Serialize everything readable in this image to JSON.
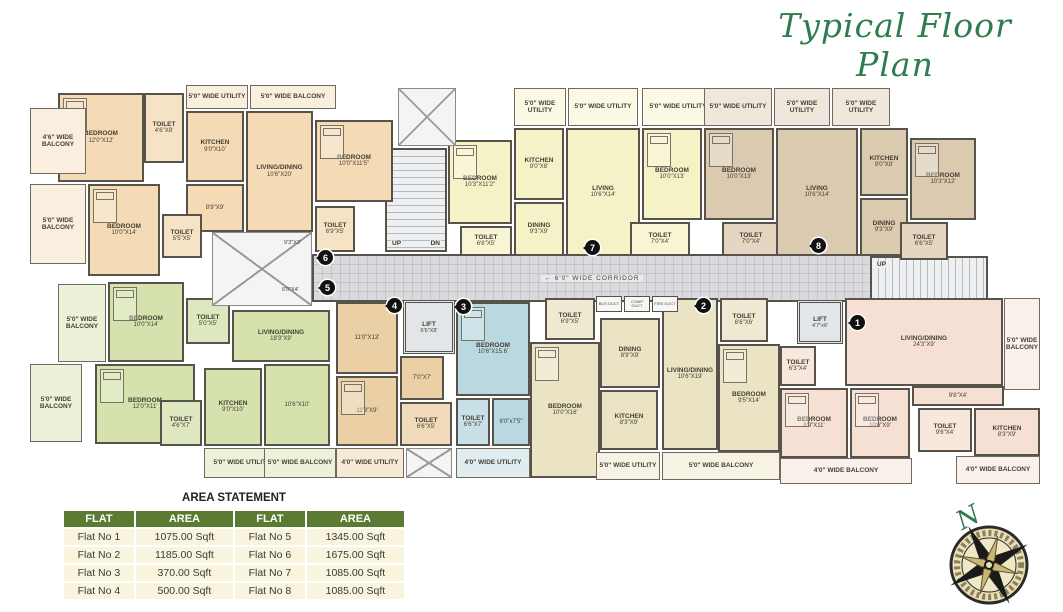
{
  "title": "Typical Floor Plan",
  "compass": {
    "north_label": "N"
  },
  "area_statement": {
    "title": "AREA STATEMENT",
    "columns": [
      "FLAT",
      "AREA",
      "FLAT",
      "AREA"
    ],
    "rows": [
      [
        "Flat No 1",
        "1075.00 Sqft",
        "Flat No 5",
        "1345.00 Sqft"
      ],
      [
        "Flat No 2",
        "1185.00 Sqft",
        "Flat No 6",
        "1675.00 Sqft"
      ],
      [
        "Flat No 3",
        "370.00 Sqft",
        "Flat No 7",
        "1085.00 Sqft"
      ],
      [
        "Flat No 4",
        "500.00 Sqft",
        "Flat No 8",
        "1085.00 Sqft"
      ]
    ]
  },
  "colors": {
    "wall": "#57524a",
    "flat1_pink": "#f5e0d3",
    "flat2_khaki": "#eae4c4",
    "flat3_blue": "#b9d8e0",
    "flat4_tan": "#ebd0a6",
    "flat5_green": "#d5e2ae",
    "flat6_peach": "#f4dbb6",
    "flat7_yellow": "#f6f2c8",
    "flat8_brown": "#dccab0",
    "table_header_green": "#5b7b33",
    "title_green": "#2e7d4f"
  },
  "common": {
    "corridor": {
      "label": "6'0\" WIDE CORRIDOR",
      "arrow": "←",
      "x": 312,
      "y": 254,
      "w": 560,
      "h": 48
    },
    "stairs": [
      {
        "dir": "h",
        "x": 385,
        "y": 148,
        "w": 62,
        "h": 104,
        "up": "UP",
        "dn": "DN"
      },
      {
        "dir": "v",
        "x": 870,
        "y": 256,
        "w": 118,
        "h": 62,
        "up": "UP",
        "dn": "DN"
      }
    ],
    "lifts": [
      {
        "label": "LIFT",
        "dims": "6'6\"X8'",
        "x": 403,
        "y": 300,
        "w": 52,
        "h": 54
      },
      {
        "label": "LIFT",
        "dims": "4'7\"x6'",
        "x": 797,
        "y": 300,
        "w": 46,
        "h": 44
      }
    ],
    "voids": [
      {
        "x": 212,
        "y": 232,
        "w": 100,
        "h": 74
      },
      {
        "x": 398,
        "y": 88,
        "w": 58,
        "h": 58
      },
      {
        "x": 406,
        "y": 448,
        "w": 46,
        "h": 30
      }
    ],
    "ducts": [
      {
        "label": "BUS DUCT",
        "x": 596,
        "y": 296,
        "w": 26,
        "h": 16
      },
      {
        "label": "COMP DUCT",
        "x": 624,
        "y": 296,
        "w": 26,
        "h": 16
      },
      {
        "label": "FIRE DUCT",
        "x": 652,
        "y": 296,
        "w": 26,
        "h": 16
      }
    ],
    "annotations": [
      {
        "text": "9'3\"X3'",
        "x": 284,
        "y": 240
      },
      {
        "text": "6'0\"X4'",
        "x": 282,
        "y": 287
      }
    ]
  },
  "flats": [
    {
      "no": "6",
      "color": "#f4dbb6",
      "marker": {
        "x": 325,
        "y": 257
      },
      "rooms": [
        {
          "label": "BEDROOM",
          "dims": "12'0\"X12'",
          "x": 58,
          "y": 93,
          "w": 86,
          "h": 89,
          "type": "room",
          "bed": true
        },
        {
          "label": "TOILET",
          "dims": "4'6\"X8'",
          "x": 144,
          "y": 93,
          "w": 40,
          "h": 70,
          "type": "toilet"
        },
        {
          "label": "5'0\" WIDE UTILITY",
          "dims": "",
          "x": 186,
          "y": 85,
          "w": 62,
          "h": 24,
          "type": "balcony"
        },
        {
          "label": "5'0\" WIDE BALCONY",
          "dims": "",
          "x": 250,
          "y": 85,
          "w": 86,
          "h": 24,
          "type": "balcony"
        },
        {
          "label": "4'6\" WIDE BALCONY",
          "dims": "",
          "x": 30,
          "y": 108,
          "w": 56,
          "h": 66,
          "type": "balcony"
        },
        {
          "label": "KITCHEN",
          "dims": "9'0\"X10'",
          "x": 186,
          "y": 111,
          "w": 58,
          "h": 71,
          "type": "room"
        },
        {
          "label": "LIVING/DINING",
          "dims": "10'6\"X20'",
          "x": 246,
          "y": 111,
          "w": 67,
          "h": 121,
          "type": "room"
        },
        {
          "label": "",
          "dims": "8'9\"X9'",
          "x": 186,
          "y": 184,
          "w": 58,
          "h": 48,
          "type": "room"
        },
        {
          "label": "BEDROOM",
          "dims": "10'0\"X14'",
          "x": 88,
          "y": 184,
          "w": 72,
          "h": 92,
          "type": "room",
          "bed": true
        },
        {
          "label": "5'0\" WIDE BALCONY",
          "dims": "",
          "x": 30,
          "y": 184,
          "w": 56,
          "h": 80,
          "type": "balcony"
        },
        {
          "label": "TOILET",
          "dims": "5'5\"X5'",
          "x": 162,
          "y": 214,
          "w": 40,
          "h": 44,
          "type": "toilet"
        },
        {
          "label": "BEDROOM",
          "dims": "10'0\"X11'5\"",
          "x": 315,
          "y": 120,
          "w": 78,
          "h": 82,
          "type": "room",
          "bed": true
        },
        {
          "label": "TOILET",
          "dims": "6'9\"X5'",
          "x": 315,
          "y": 206,
          "w": 40,
          "h": 46,
          "type": "toilet"
        }
      ]
    },
    {
      "no": "7",
      "color": "#f6f2c8",
      "marker": {
        "x": 592,
        "y": 247
      },
      "rooms": [
        {
          "label": "BEDROOM",
          "dims": "10'3\"X11'2\"",
          "x": 448,
          "y": 140,
          "w": 64,
          "h": 84,
          "type": "room",
          "bed": true
        },
        {
          "label": "TOILET",
          "dims": "6'6\"X5'",
          "x": 460,
          "y": 226,
          "w": 52,
          "h": 30,
          "type": "toilet"
        },
        {
          "label": "5'0\" WIDE UTILITY",
          "dims": "",
          "x": 514,
          "y": 88,
          "w": 52,
          "h": 38,
          "type": "balcony"
        },
        {
          "label": "5'0\" WIDE UTILITY",
          "dims": "",
          "x": 568,
          "y": 88,
          "w": 70,
          "h": 38,
          "type": "balcony"
        },
        {
          "label": "KITCHEN",
          "dims": "9'0\"X8'",
          "x": 514,
          "y": 128,
          "w": 50,
          "h": 72,
          "type": "room"
        },
        {
          "label": "DINING",
          "dims": "9'3\"X9'",
          "x": 514,
          "y": 202,
          "w": 50,
          "h": 54,
          "type": "room"
        },
        {
          "label": "LIVING",
          "dims": "10'6\"X14'",
          "x": 566,
          "y": 128,
          "w": 74,
          "h": 128,
          "type": "room"
        },
        {
          "label": "5'0\" WIDE UTILITY",
          "dims": "",
          "x": 642,
          "y": 88,
          "w": 72,
          "h": 38,
          "type": "balcony"
        },
        {
          "label": "BEDROOM",
          "dims": "10'0\"X13'",
          "x": 642,
          "y": 128,
          "w": 60,
          "h": 92,
          "type": "room",
          "bed": true
        },
        {
          "label": "TOILET",
          "dims": "7'0\"X4'",
          "x": 630,
          "y": 222,
          "w": 60,
          "h": 34,
          "type": "toilet"
        }
      ]
    },
    {
      "no": "8",
      "color": "#dccab0",
      "marker": {
        "x": 818,
        "y": 245
      },
      "rooms": [
        {
          "label": "5'0\" WIDE UTILITY",
          "dims": "",
          "x": 704,
          "y": 88,
          "w": 68,
          "h": 38,
          "type": "balcony"
        },
        {
          "label": "5'0\" WIDE UTILITY",
          "dims": "",
          "x": 774,
          "y": 88,
          "w": 56,
          "h": 38,
          "type": "balcony"
        },
        {
          "label": "5'0\" WIDE UTILITY",
          "dims": "",
          "x": 832,
          "y": 88,
          "w": 58,
          "h": 38,
          "type": "balcony"
        },
        {
          "label": "BEDROOM",
          "dims": "10'0\"X13'",
          "x": 704,
          "y": 128,
          "w": 70,
          "h": 92,
          "type": "room",
          "bed": true
        },
        {
          "label": "TOILET",
          "dims": "7'0\"X4'",
          "x": 722,
          "y": 222,
          "w": 58,
          "h": 34,
          "type": "toilet"
        },
        {
          "label": "LIVING",
          "dims": "10'6\"X14'",
          "x": 776,
          "y": 128,
          "w": 82,
          "h": 128,
          "type": "room"
        },
        {
          "label": "KITCHEN",
          "dims": "9'0\"X8'",
          "x": 860,
          "y": 128,
          "w": 48,
          "h": 68,
          "type": "room"
        },
        {
          "label": "DINING",
          "dims": "9'3\"X9'",
          "x": 860,
          "y": 198,
          "w": 48,
          "h": 58,
          "type": "room"
        },
        {
          "label": "BEDROOM",
          "dims": "10'3\"X12'",
          "x": 910,
          "y": 138,
          "w": 66,
          "h": 82,
          "type": "room",
          "bed": true
        },
        {
          "label": "TOILET",
          "dims": "6'6\"X5'",
          "x": 900,
          "y": 222,
          "w": 48,
          "h": 38,
          "type": "toilet"
        }
      ]
    },
    {
      "no": "5",
      "color": "#d5e2ae",
      "marker": {
        "x": 327,
        "y": 287
      },
      "rooms": [
        {
          "label": "5'0\" WIDE BALCONY",
          "dims": "",
          "x": 58,
          "y": 284,
          "w": 48,
          "h": 78,
          "type": "balcony"
        },
        {
          "label": "BEDROOM",
          "dims": "10'0\"X14'",
          "x": 108,
          "y": 282,
          "w": 76,
          "h": 80,
          "type": "room",
          "bed": true
        },
        {
          "label": "TOILET",
          "dims": "5'0\"X5'",
          "x": 186,
          "y": 298,
          "w": 44,
          "h": 46,
          "type": "toilet"
        },
        {
          "label": "BEDROOM",
          "dims": "12'0\"X11'",
          "x": 95,
          "y": 364,
          "w": 100,
          "h": 80,
          "type": "room",
          "bed": true
        },
        {
          "label": "5'0\" WIDE BALCONY",
          "dims": "",
          "x": 30,
          "y": 364,
          "w": 52,
          "h": 78,
          "type": "balcony"
        },
        {
          "label": "TOILET",
          "dims": "4'6\"X7'",
          "x": 160,
          "y": 400,
          "w": 42,
          "h": 46,
          "type": "toilet"
        },
        {
          "label": "KITCHEN",
          "dims": "9'0\"X10'",
          "x": 204,
          "y": 368,
          "w": 58,
          "h": 78,
          "type": "room"
        },
        {
          "label": "5'0\" WIDE UTILITY",
          "dims": "",
          "x": 204,
          "y": 448,
          "w": 76,
          "h": 30,
          "type": "balcony"
        },
        {
          "label": "LIVING/DINING",
          "dims": "18'3\"X9'",
          "x": 232,
          "y": 310,
          "w": 98,
          "h": 52,
          "type": "room"
        },
        {
          "label": "",
          "dims": "10'6\"X10'",
          "x": 264,
          "y": 364,
          "w": 66,
          "h": 82,
          "type": "room"
        },
        {
          "label": "5'0\" WIDE BALCONY",
          "dims": "",
          "x": 264,
          "y": 448,
          "w": 72,
          "h": 30,
          "type": "balcony"
        }
      ]
    },
    {
      "no": "4",
      "color": "#ebd0a6",
      "marker": {
        "x": 394,
        "y": 305
      },
      "rooms": [
        {
          "label": "",
          "dims": "11'0\"X13'",
          "x": 336,
          "y": 302,
          "w": 62,
          "h": 72,
          "type": "room"
        },
        {
          "label": "",
          "dims": "11'3\"X9'",
          "x": 336,
          "y": 376,
          "w": 62,
          "h": 70,
          "type": "room",
          "bed": true
        },
        {
          "label": "",
          "dims": "7'0\"X7'",
          "x": 400,
          "y": 356,
          "w": 44,
          "h": 44,
          "type": "room"
        },
        {
          "label": "TOILET",
          "dims": "6'6\"X5'",
          "x": 400,
          "y": 402,
          "w": 52,
          "h": 44,
          "type": "toilet"
        },
        {
          "label": "4'0\" WIDE UTILITY",
          "dims": "",
          "x": 336,
          "y": 448,
          "w": 68,
          "h": 30,
          "type": "balcony"
        }
      ]
    },
    {
      "no": "3",
      "color": "#b9d8e0",
      "marker": {
        "x": 463,
        "y": 306
      },
      "rooms": [
        {
          "label": "BEDROOM",
          "dims": "10'6\"X15.6'",
          "x": 456,
          "y": 302,
          "w": 74,
          "h": 94,
          "type": "room",
          "bed": true
        },
        {
          "label": "TOILET",
          "dims": "6'6\"X7'",
          "x": 456,
          "y": 398,
          "w": 34,
          "h": 48,
          "type": "toilet"
        },
        {
          "label": "",
          "dims": "6'0\"x7'5\"",
          "x": 492,
          "y": 398,
          "w": 38,
          "h": 48,
          "type": "room"
        },
        {
          "label": "4'0\" WIDE UTILITY",
          "dims": "",
          "x": 456,
          "y": 448,
          "w": 74,
          "h": 30,
          "type": "balcony"
        }
      ]
    },
    {
      "no": "2",
      "color": "#eae4c4",
      "marker": {
        "x": 703,
        "y": 305
      },
      "rooms": [
        {
          "label": "TOILET",
          "dims": "6'9\"X5'",
          "x": 545,
          "y": 298,
          "w": 50,
          "h": 42,
          "type": "toilet"
        },
        {
          "label": "BEDROOM",
          "dims": "10'0\"X16'",
          "x": 530,
          "y": 342,
          "w": 70,
          "h": 136,
          "type": "room",
          "bed": true
        },
        {
          "label": "DINING",
          "dims": "8'9\"X9'",
          "x": 600,
          "y": 318,
          "w": 60,
          "h": 70,
          "type": "room"
        },
        {
          "label": "KITCHEN",
          "dims": "8'3\"X9'",
          "x": 600,
          "y": 390,
          "w": 58,
          "h": 60,
          "type": "room"
        },
        {
          "label": "LIVING/DINING",
          "dims": "10'6\"X19'",
          "x": 662,
          "y": 298,
          "w": 56,
          "h": 152,
          "type": "room"
        },
        {
          "label": "TOILET",
          "dims": "6'6\"X6'",
          "x": 720,
          "y": 298,
          "w": 48,
          "h": 44,
          "type": "toilet"
        },
        {
          "label": "BEDROOM",
          "dims": "9'5\"X14'",
          "x": 718,
          "y": 344,
          "w": 62,
          "h": 108,
          "type": "room",
          "bed": true
        },
        {
          "label": "5'0\" WIDE UTILITY",
          "dims": "",
          "x": 596,
          "y": 452,
          "w": 64,
          "h": 28,
          "type": "balcony"
        },
        {
          "label": "5'0\" WIDE BALCONY",
          "dims": "",
          "x": 662,
          "y": 452,
          "w": 118,
          "h": 28,
          "type": "balcony"
        }
      ]
    },
    {
      "no": "1",
      "color": "#f5e0d3",
      "marker": {
        "x": 857,
        "y": 322
      },
      "rooms": [
        {
          "label": "LIVING/DINING",
          "dims": "24'3\"X9'",
          "x": 845,
          "y": 298,
          "w": 158,
          "h": 88,
          "type": "room"
        },
        {
          "label": "5'0\" WIDE BALCONY",
          "dims": "",
          "x": 1004,
          "y": 298,
          "w": 36,
          "h": 92,
          "type": "balcony"
        },
        {
          "label": "TOILET",
          "dims": "6'3\"X4'",
          "x": 780,
          "y": 346,
          "w": 36,
          "h": 40,
          "type": "toilet"
        },
        {
          "label": "BEDROOM",
          "dims": "9'9\"X11'",
          "x": 780,
          "y": 388,
          "w": 68,
          "h": 70,
          "type": "room",
          "bed": true
        },
        {
          "label": "BEDROOM",
          "dims": "10'6\"X9'",
          "x": 850,
          "y": 388,
          "w": 60,
          "h": 70,
          "type": "room",
          "bed": true
        },
        {
          "label": "",
          "dims": "9'6\"X4'",
          "x": 912,
          "y": 386,
          "w": 92,
          "h": 20,
          "type": "room"
        },
        {
          "label": "TOILET",
          "dims": "9'6\"X4'",
          "x": 918,
          "y": 408,
          "w": 54,
          "h": 44,
          "type": "toilet"
        },
        {
          "label": "KITCHEN",
          "dims": "8'3\"X9'",
          "x": 974,
          "y": 408,
          "w": 66,
          "h": 48,
          "type": "room"
        },
        {
          "label": "4'0\" WIDE BALCONY",
          "dims": "",
          "x": 780,
          "y": 458,
          "w": 132,
          "h": 26,
          "type": "balcony"
        },
        {
          "label": "4'0\" WIDE BALCONY",
          "dims": "",
          "x": 956,
          "y": 456,
          "w": 84,
          "h": 28,
          "type": "balcony"
        }
      ]
    }
  ]
}
